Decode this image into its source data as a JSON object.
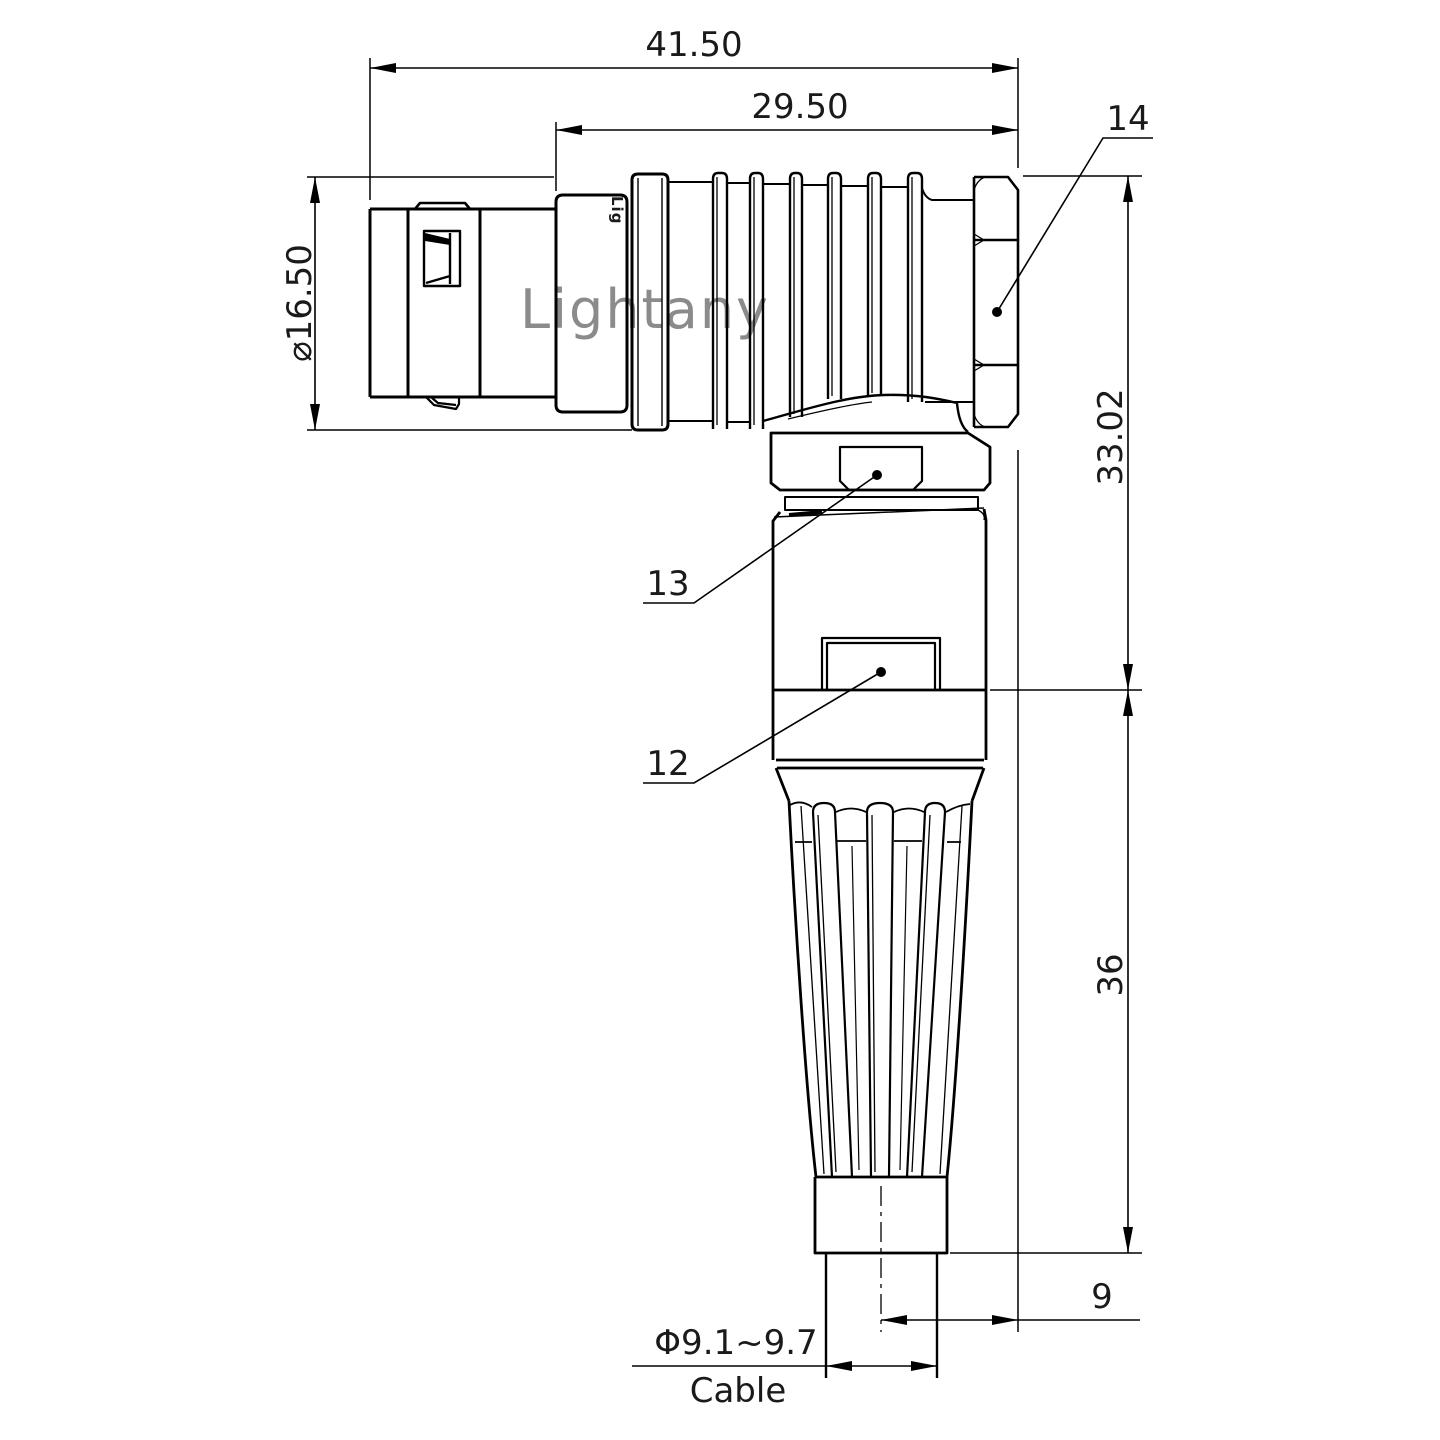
{
  "drawing": {
    "watermark": "Lightany",
    "part_marking": "Lig",
    "dimensions": {
      "overall_length": "41.50",
      "rear_length": "29.50",
      "front_diameter": "⌀16.50",
      "elbow_height": "33.02",
      "boot_length": "36",
      "cable_offset": "9",
      "cable_diameter": "Φ9.1~9.7",
      "cable_label": "Cable"
    },
    "part_labels": {
      "backnut": "14",
      "coupling_ring": "13",
      "body_shell": "12"
    },
    "colors": {
      "line": "#000000",
      "background": "#ffffff",
      "watermark": "#efc0c0"
    }
  }
}
